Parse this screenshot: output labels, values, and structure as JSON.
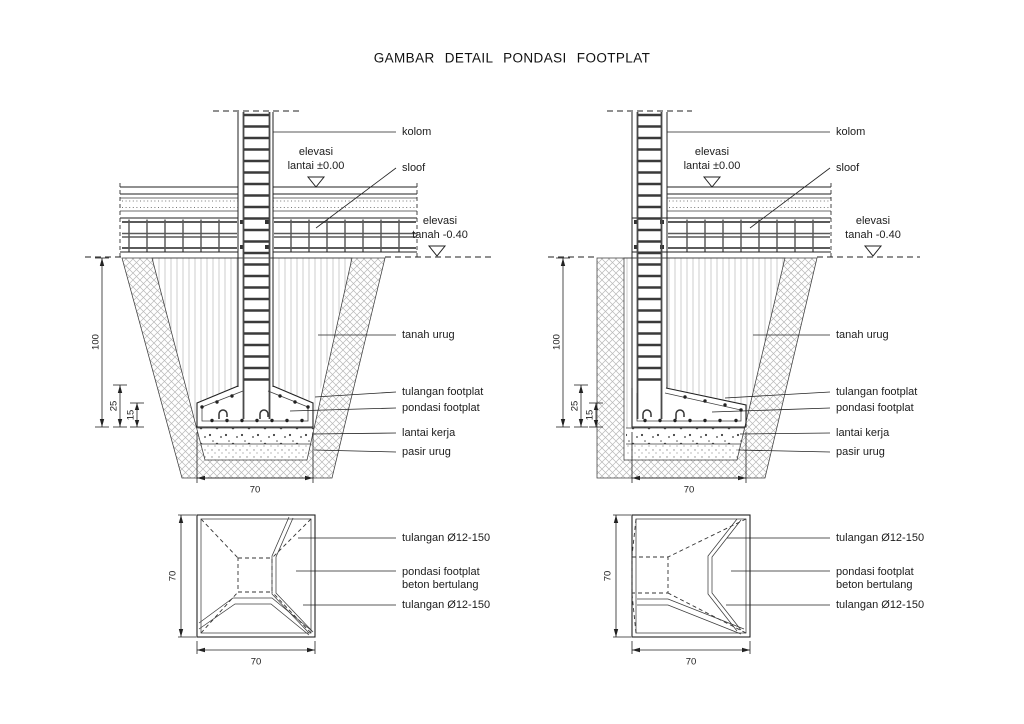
{
  "title": "GAMBAR DETAIL PONDASI FOOTPLAT",
  "colors": {
    "ink": "#1c1c1c",
    "line": "#222222",
    "rebar": "#4a4a4a",
    "hatch": "#b8b8b8",
    "background": "#ffffff"
  },
  "section_labels": {
    "kolom": "kolom",
    "sloof": "sloof",
    "elevasi_lantai_line1": "elevasi",
    "elevasi_lantai_line2": "lantai ±0.00",
    "elevasi_tanah_line1": "elevasi",
    "elevasi_tanah_line2": "tanah -0.40",
    "tanah_urug": "tanah urug",
    "tulangan_footplat": "tulangan footplat",
    "pondasi_footplat": "pondasi footplat",
    "lantai_kerja": "lantai kerja",
    "pasir_urug": "pasir urug"
  },
  "plan_labels": {
    "tulangan_top": "tulangan Ø12-150",
    "pondasi_line1": "pondasi footplat",
    "pondasi_line2": "beton bertulang",
    "tulangan_bottom": "tulangan Ø12-150"
  },
  "dimensions": {
    "depth": "100",
    "footing_height": "25",
    "footing_edge": "15",
    "width_70": "70"
  }
}
